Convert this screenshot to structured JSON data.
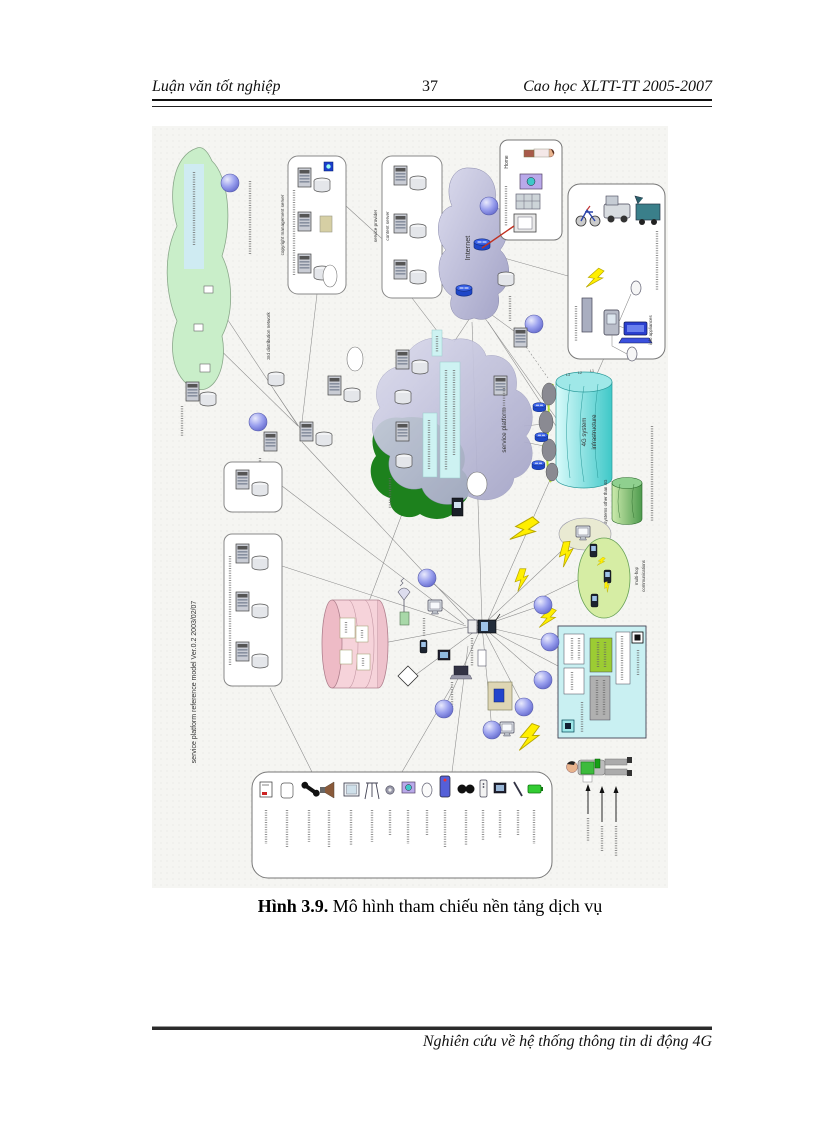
{
  "header": {
    "left": "Luận văn tốt nghiệp",
    "page_number": "37",
    "right": "Cao học  XLTT-TT 2005-2007"
  },
  "caption": {
    "bold": "Hình 3.9.",
    "rest": " Mô hình tham chiếu nền tảng dịch vụ"
  },
  "footer": {
    "right": "Nghiên cứu về hệ thống thông tin di động 4G"
  },
  "diagram": {
    "version_label": "service platform reference model Ver.0.2 2003/02/07",
    "labels": {
      "dist_network": "3rd distribution network",
      "copyright_server": "copyright management server",
      "service_provider": "service provider",
      "content_server": "content server",
      "internet": "Internet",
      "home": "Home",
      "service_platform": "service platform",
      "infrastructure_1": "4G system",
      "infrastructure_2": "infrastructure",
      "other_systems": "Systems other than 4G",
      "multi_hop_1": "multi-hop",
      "multi_hop_2": "communications",
      "info_appliances": "info appliances",
      "layer_1": "L1",
      "layer_2": "L2",
      "layer_3": "L3"
    },
    "icons": {
      "node_sphere": "network-node-sphere",
      "router": "router",
      "server": "server-tower",
      "database": "database-cylinder",
      "bolt": "wireless-link-bolt"
    },
    "colors": {
      "cloud_green": "#c9eec9",
      "cloud_purple": "#c3c3dc",
      "dark_green": "#117a11",
      "cyan_cylinder": "#4cc8c8",
      "green_cylinder": "#5aa05a",
      "pink_cylinder": "#f6d3da",
      "bolt_yellow": "#ffef00",
      "sphere_purple": "#8a8fe8",
      "router_blue": "#2a52d8",
      "legend_bg": "#c9f0f2",
      "multi_hop_green": "#d6eda4"
    }
  }
}
